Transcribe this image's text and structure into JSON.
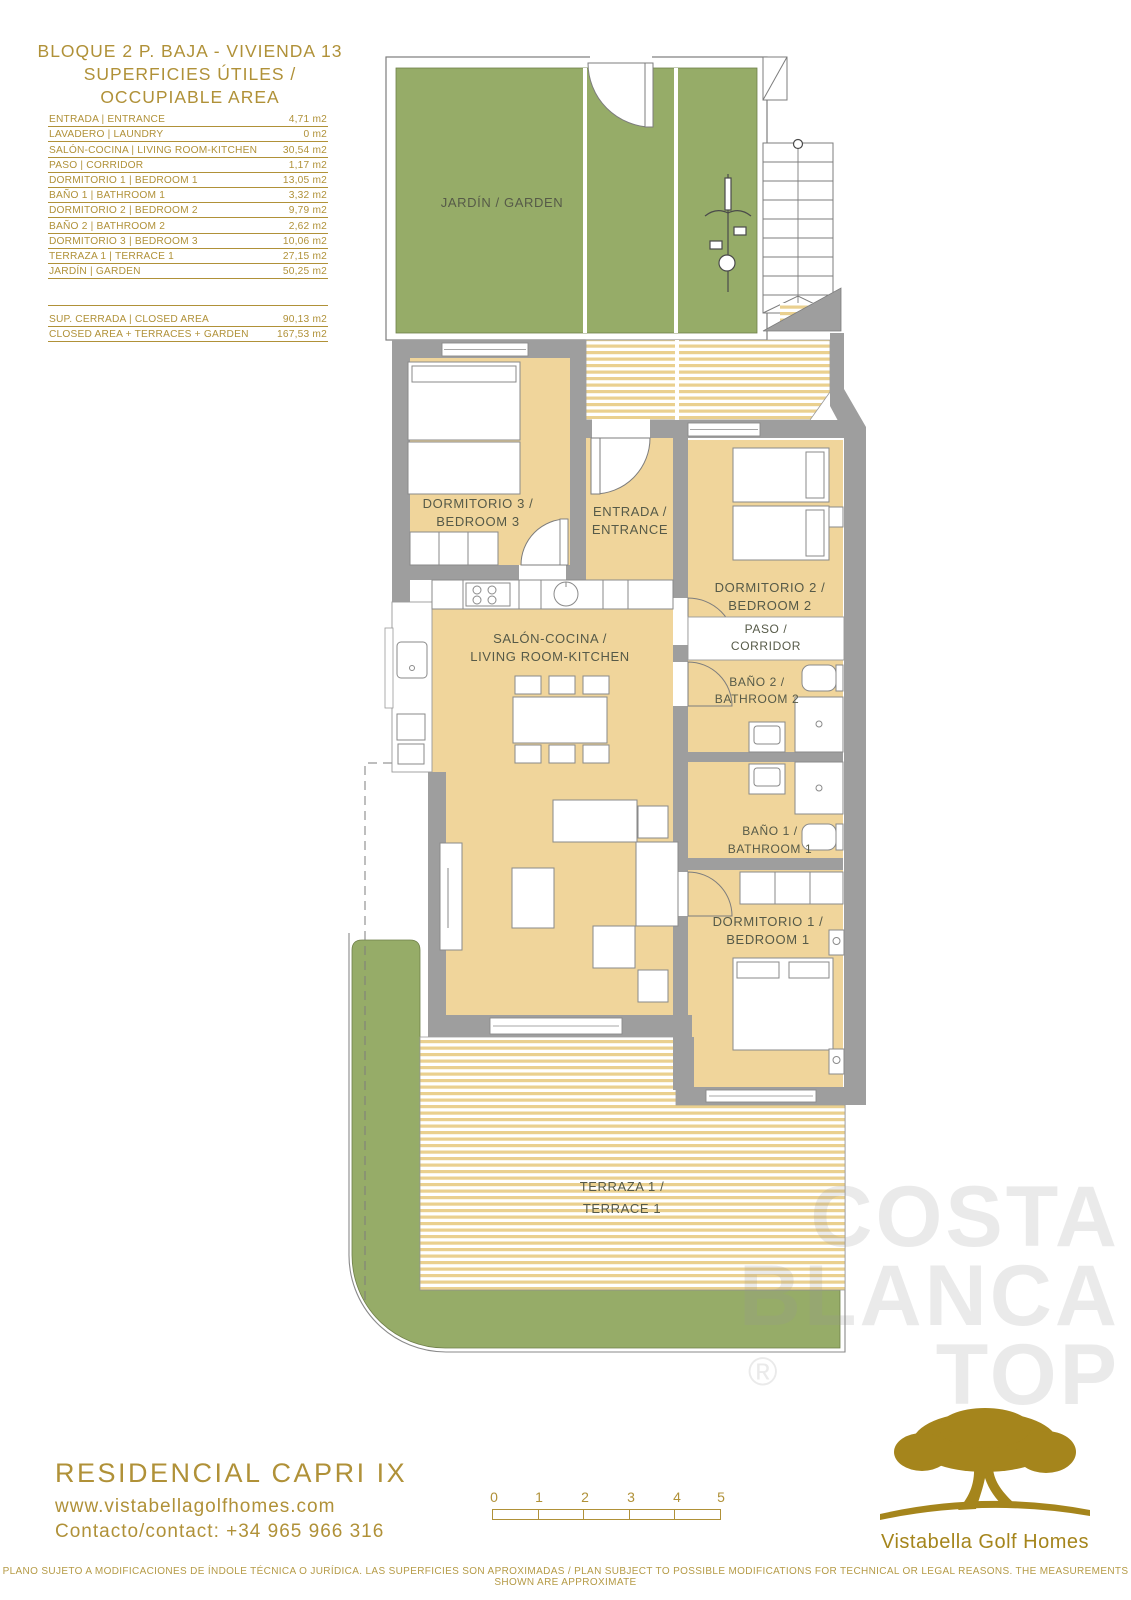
{
  "header": {
    "title_line1": "BLOQUE 2 P. BAJA - VIVIENDA 13",
    "title_line2": "SUPERFICIES ÚTILES / OCCUPIABLE AREA"
  },
  "area_table": {
    "rows": [
      {
        "label": "ENTRADA | ENTRANCE",
        "value": "4,71 m2"
      },
      {
        "label": "LAVADERO | LAUNDRY",
        "value": "0 m2"
      },
      {
        "label": "SALÓN-COCINA | LIVING ROOM-KITCHEN",
        "value": "30,54 m2"
      },
      {
        "label": "PASO | CORRIDOR",
        "value": "1,17 m2"
      },
      {
        "label": "DORMITORIO 1 | BEDROOM 1",
        "value": "13,05 m2"
      },
      {
        "label": "BAÑO 1 | BATHROOM 1",
        "value": "3,32 m2"
      },
      {
        "label": "DORMITORIO 2 | BEDROOM 2",
        "value": "9,79 m2"
      },
      {
        "label": "BAÑO 2 | BATHROOM 2",
        "value": "2,62 m2"
      },
      {
        "label": "DORMITORIO 3 | BEDROOM 3",
        "value": "10,06 m2"
      },
      {
        "label": "TERRAZA 1 | TERRACE 1",
        "value": "27,15 m2"
      },
      {
        "label": "JARDÍN | GARDEN",
        "value": "50,25 m2"
      }
    ],
    "summary": [
      {
        "label": "SUP. CERRADA | CLOSED AREA",
        "value": "90,13 m2"
      },
      {
        "label": "CLOSED AREA + TERRACES + GARDEN",
        "value": "167,53 m2"
      }
    ]
  },
  "plan": {
    "labels": {
      "garden": "JARDÍN / GARDEN",
      "bedroom3_1": "DORMITORIO 3 /",
      "bedroom3_2": "BEDROOM 3",
      "entrance_1": "ENTRADA /",
      "entrance_2": "ENTRANCE",
      "living_1": "SALÓN-COCINA /",
      "living_2": "LIVING ROOM-KITCHEN",
      "bedroom2_1": "DORMITORIO 2 /",
      "bedroom2_2": "BEDROOM 2",
      "paso_1": "PASO /",
      "paso_2": "CORRIDOR",
      "bath2_1": "BAÑO 2 /",
      "bath2_2": "BATHROOM 2",
      "bath1_1": "BAÑO 1 /",
      "bath1_2": "BATHROOM 1",
      "bedroom1_1": "DORMITORIO 1 /",
      "bedroom1_2": "BEDROOM 1",
      "terrace_1": "TERRAZA 1 /",
      "terrace_2": "TERRACE 1"
    }
  },
  "scale_bar": {
    "ticks": [
      "0",
      "1",
      "2",
      "3",
      "4",
      "5"
    ]
  },
  "watermark": {
    "line1": "COSTA",
    "line2": "BLANCA",
    "line3": "TOP",
    "reg": "®"
  },
  "footer": {
    "project": "RESIDENCIAL CAPRI IX",
    "website": "www.vistabellagolfhomes.com",
    "contact": "Contacto/contact: +34 965 966 316",
    "brand": "Vistabella Golf Homes",
    "disclaimer": "PLANO SUJETO A MODIFICACIONES DE ÍNDOLE TÉCNICA O JURÍDICA. LAS SUPERFICIES SON APROXIMADAS / PLAN SUBJECT TO POSSIBLE MODIFICATIONS FOR TECHNICAL OR LEGAL REASONS. THE MEASUREMENTS SHOWN ARE APPROXIMATE"
  },
  "colors": {
    "accent_gold": "#B09138",
    "logo_gold": "#A5851C",
    "garden_green": "#96AC68",
    "floor_tan": "#F0D59B",
    "wall_gray": "#9E9E9E"
  }
}
